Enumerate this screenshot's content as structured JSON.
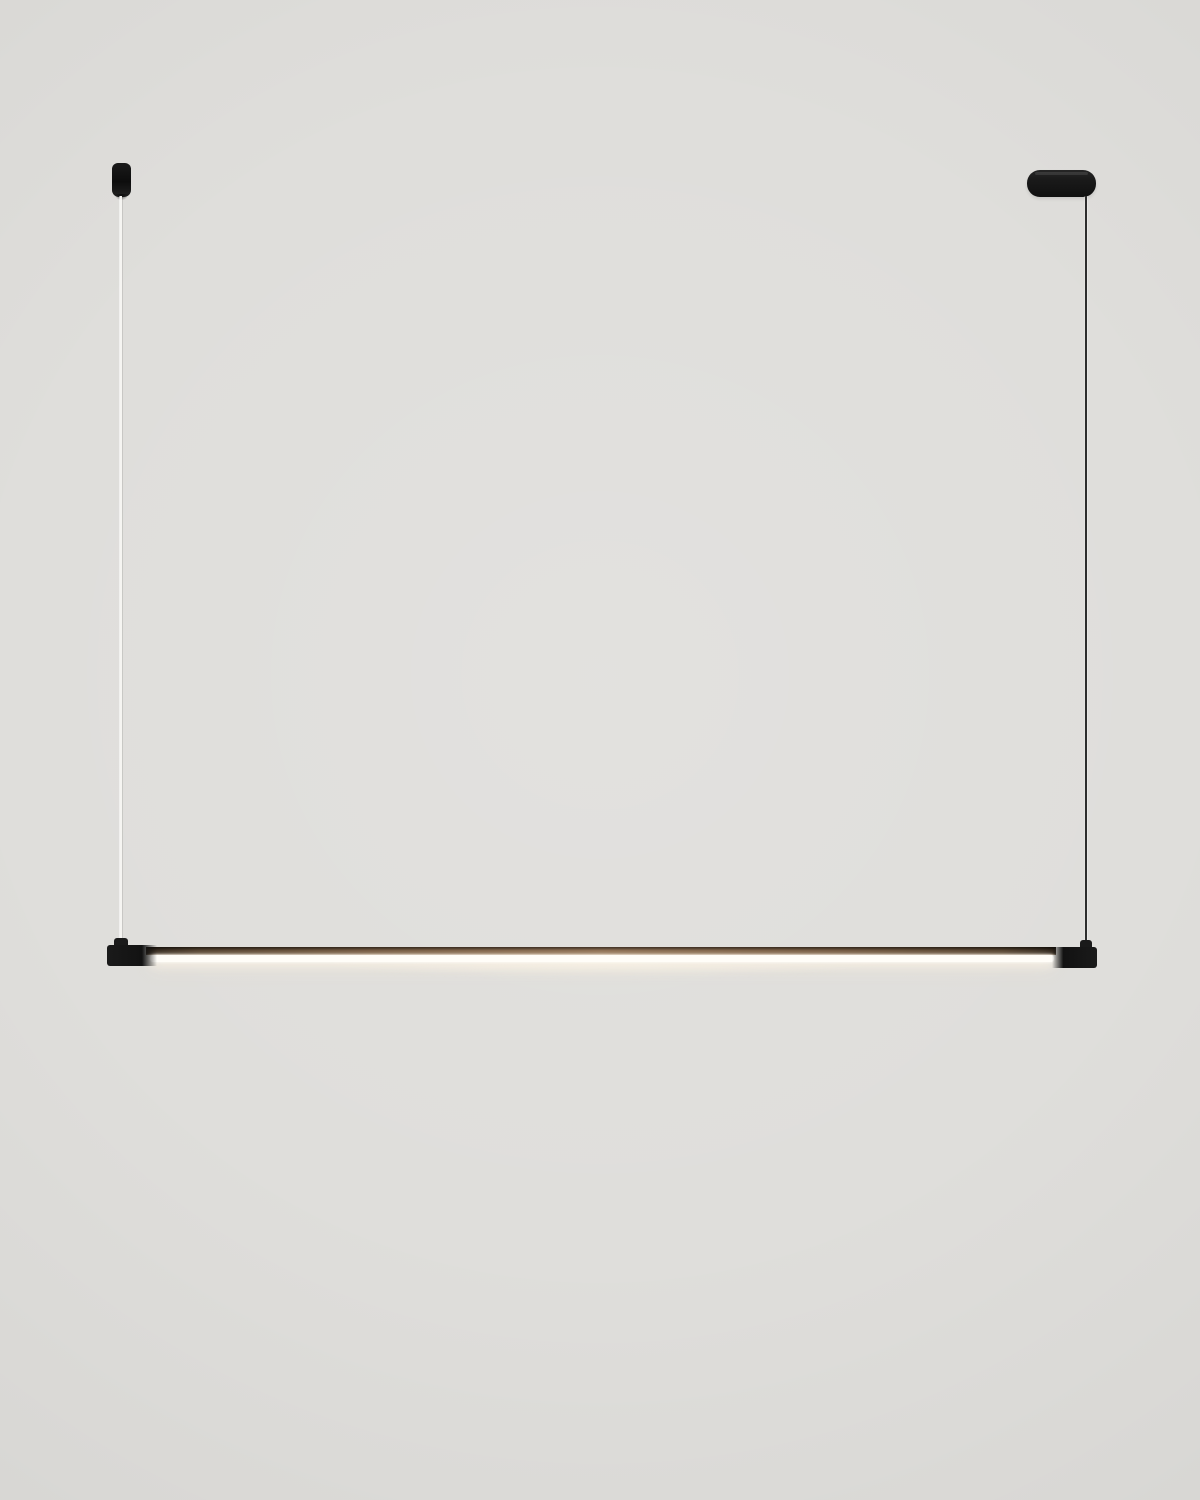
{
  "colors": {
    "background": "#dfdedb",
    "fixture_black": "#1a1a1a",
    "cable_light": "#f6f5f2",
    "cable_dark": "#2d2d2d",
    "housing_bronze": "#6e5238",
    "housing_bronze_light": "#8a6a4c",
    "led_white": "#fffdf8"
  },
  "scene": {
    "subject": "linear-led-pendant-lamp",
    "elements": {
      "mount_left": "cylindrical ceiling mount, matte black",
      "canopy_right": "pill-shaped ceiling canopy, matte black",
      "cable_left": "thin light suspension cable",
      "cable_right": "thin dark suspension cable",
      "bar": "horizontal light bar with black end caps, bronze housing and lit white LED strip"
    }
  }
}
